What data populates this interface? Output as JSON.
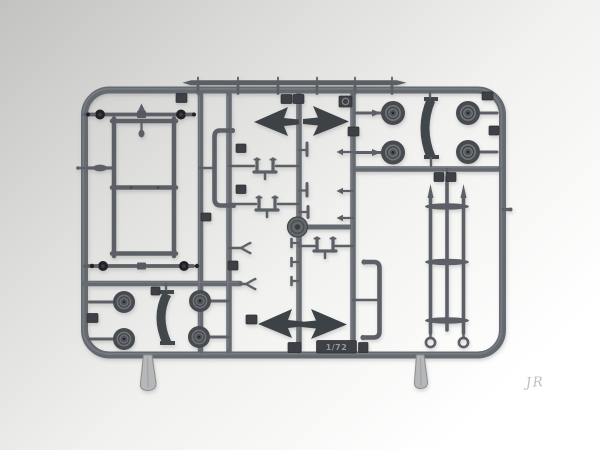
{
  "photo": {
    "molded_scale_label": "1/72",
    "watermark_signature": "JR"
  },
  "palette": {
    "background_top_left": "#c2c2c0",
    "background_bottom": "#ffffff",
    "plastic_runner": "#656a70",
    "plastic_part": "#5c6066",
    "plastic_dark_tag": "#3d4145",
    "wheel_tire": "#474b4f",
    "wheel_rim": "#707478",
    "axle_end_black": "#212427",
    "gate_tab_grey": "#b6b7b8",
    "watermark_grey": "#bfbfc1"
  }
}
